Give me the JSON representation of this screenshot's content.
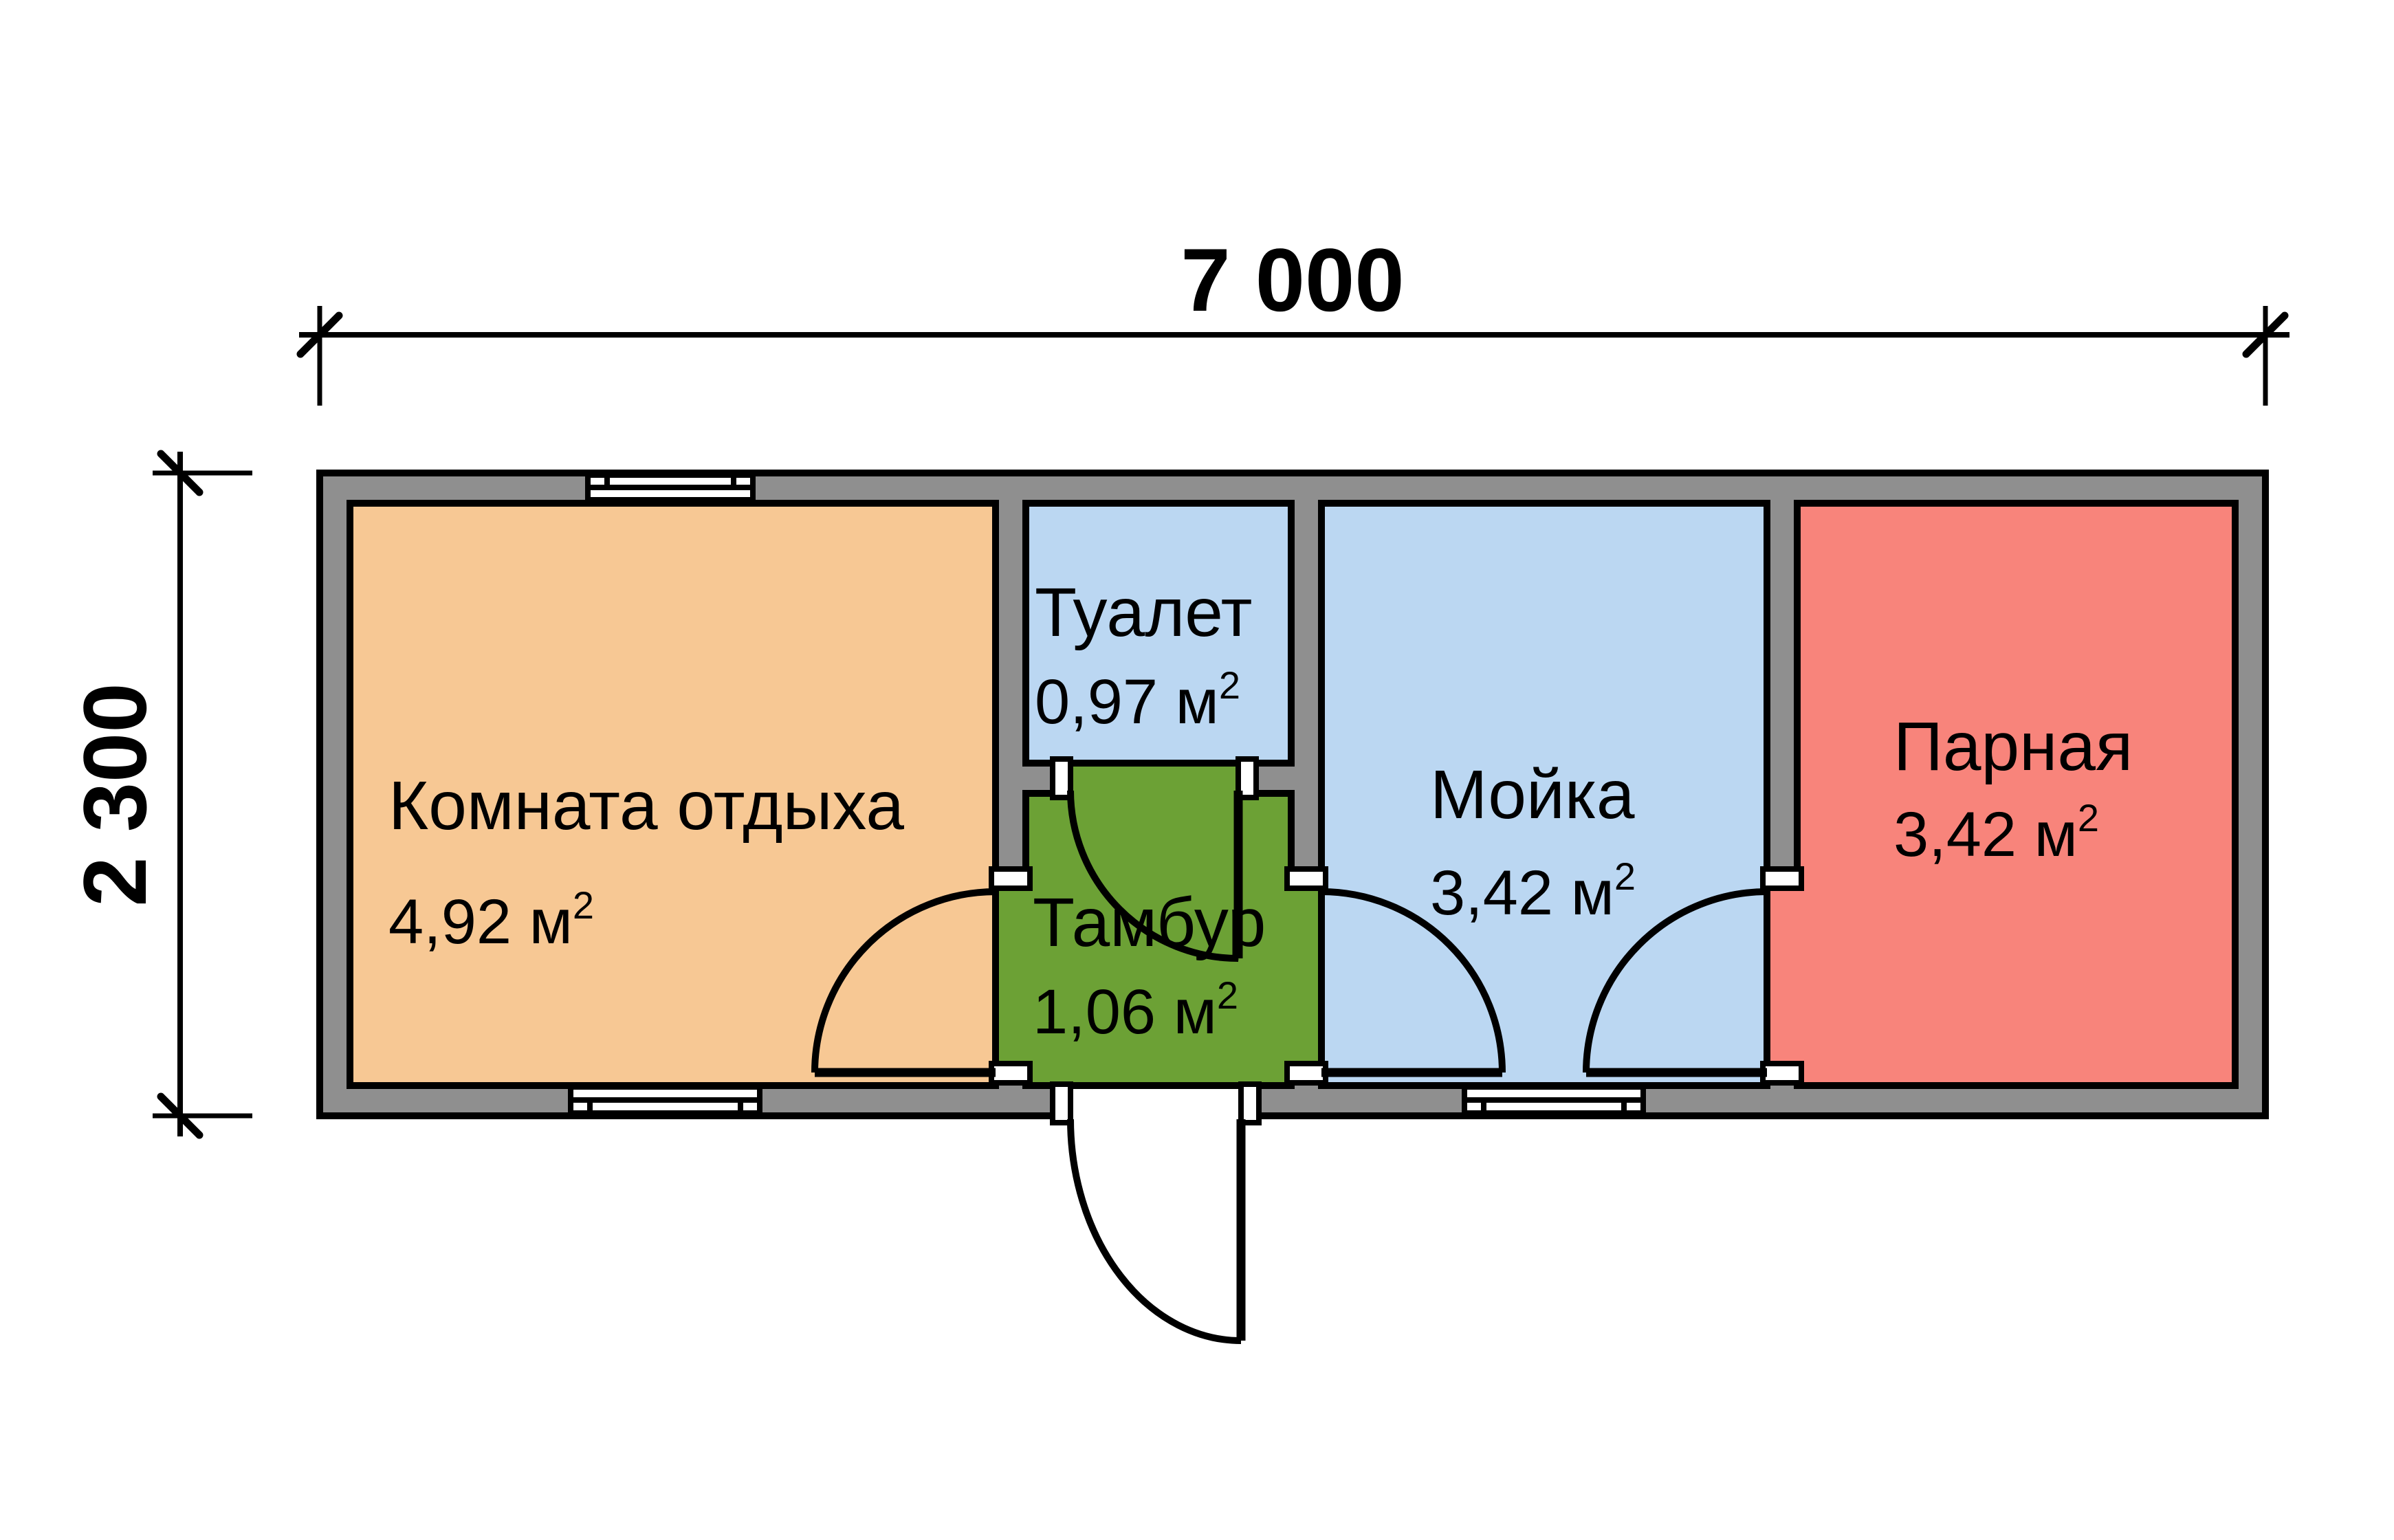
{
  "plan": {
    "type": "floor-plan",
    "background": "#FFFFFF",
    "wall_color": "#8F8F8F",
    "outline_color": "#000000"
  },
  "dimensions": {
    "width_label": "7 000",
    "height_label": "2 300"
  },
  "rooms": {
    "lounge": {
      "name": "Комната отдыха",
      "area": "4,92 м",
      "area_sup": "2",
      "color": "#F7C894"
    },
    "toilet": {
      "name": "Туалет",
      "area": "0,97 м",
      "area_sup": "2",
      "color": "#BBD7F2"
    },
    "tambour": {
      "name": "Тамбур",
      "area": "1,06 м",
      "area_sup": "2",
      "color": "#6CA135"
    },
    "washroom": {
      "name": "Мойка",
      "area": "3,42 м",
      "area_sup": "2",
      "color": "#BBD7F2"
    },
    "steam": {
      "name": "Парная",
      "area": "3,42 м",
      "area_sup": "2",
      "color": "#F8847B"
    }
  }
}
